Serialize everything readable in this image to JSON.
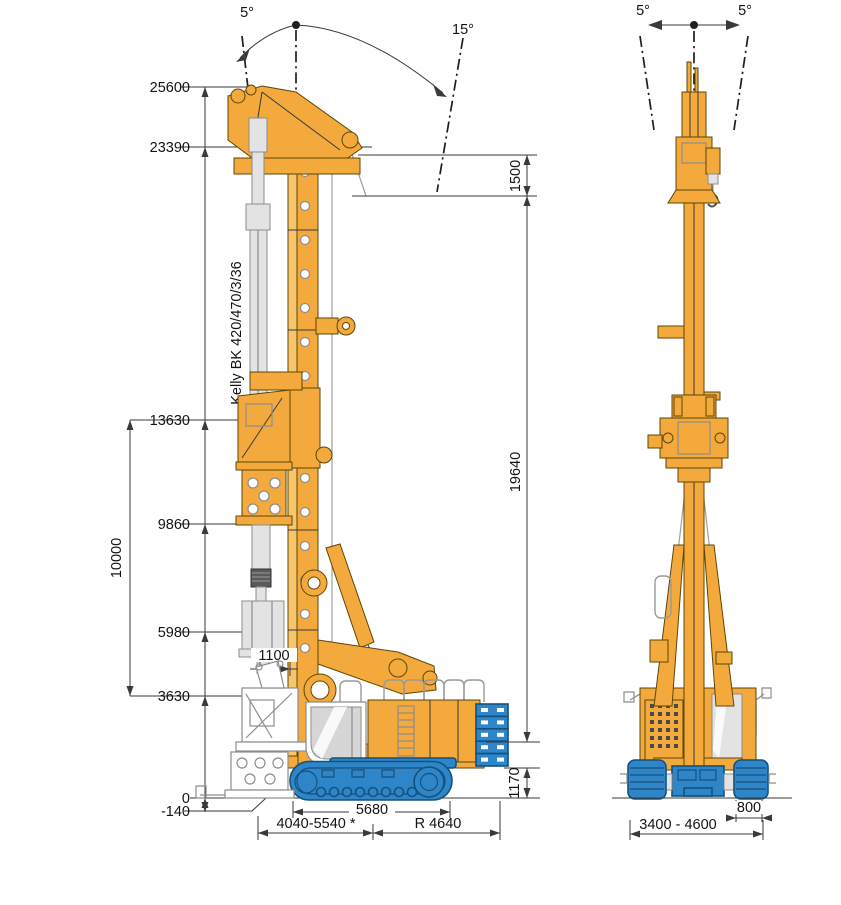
{
  "diagram": {
    "title": "rotary drilling rig dimension drawing",
    "side_view": {
      "tilt_back_angle": "5°",
      "tilt_forward_angle": "15°",
      "kelly_label": "Kelly BK 420/470/3/36",
      "heights": [
        "25600",
        "23390",
        "13630",
        "9860",
        "5980",
        "3630",
        "0",
        "-140"
      ],
      "dim_kelly_stroke": "10000",
      "dim_head_section": "1500",
      "dim_mast_length": "19640",
      "dim_uppercarriage_height": "1170",
      "dim_axis_offset": "1100",
      "dim_track_length": "5680",
      "dim_reach_range": "4040-5540 *",
      "dim_tail_radius": "R 4640"
    },
    "front_view": {
      "tilt_left_angle": "5°",
      "tilt_right_angle": "5°",
      "dim_track_shoe_width": "800",
      "dim_undercarriage_width": "3400 - 4600"
    },
    "colors": {
      "machine_yellow": "#F3A93C",
      "machine_yellow_light": "#F8C56B",
      "machine_outline": "#5d4706",
      "track_blue": "#2E86C8",
      "track_blue_dark": "#14517C",
      "part_grey": "#E3E3E3"
    }
  }
}
